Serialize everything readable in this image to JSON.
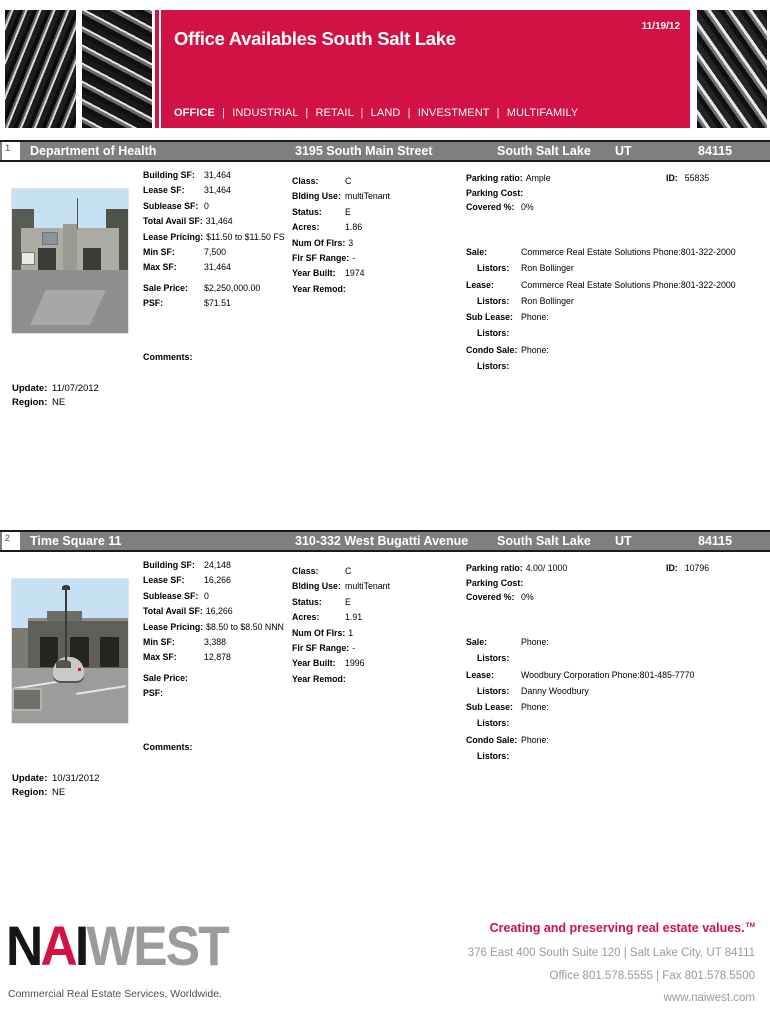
{
  "header": {
    "title": "Office Availables South Salt Lake",
    "date": "11/19/12",
    "nav": [
      "OFFICE",
      "INDUSTRIAL",
      "RETAIL",
      "LAND",
      "INVESTMENT",
      "MULTIFAMILY"
    ],
    "nav_separator": "|"
  },
  "colors": {
    "accent": "#D21145",
    "listing_bar": "#7F7F7F"
  },
  "listings": [
    {
      "num": "1",
      "name": "Department of Health",
      "address": "3195 South Main Street",
      "city": "South Salt Lake",
      "state": "UT",
      "zip": "84115",
      "col1": [
        {
          "label": "Building SF:",
          "value": "31,464"
        },
        {
          "label": "Lease SF:",
          "value": "31,464"
        },
        {
          "label": "Sublease SF:",
          "value": "0"
        },
        {
          "label": "Total Avail SF:",
          "value": "31,464"
        },
        {
          "label": "Lease Pricing:",
          "value": "$11.50 to $11.50 FS"
        },
        {
          "label": "Min SF:",
          "value": "7,500"
        },
        {
          "label": "Max SF:",
          "value": "31,464"
        }
      ],
      "col1b": [
        {
          "label": "Sale Price:",
          "value": "$2,250,000.00"
        },
        {
          "label": "PSF:",
          "value": "$71.51"
        }
      ],
      "col2": [
        {
          "label": "Class:",
          "value": "C"
        },
        {
          "label": "Blding Use:",
          "value": "multiTenant"
        },
        {
          "label": "Status:",
          "value": "E"
        },
        {
          "label": "Acres:",
          "value": "1.86"
        },
        {
          "label": "Num Of Flrs:",
          "value": "3"
        },
        {
          "label": "Flr SF Range:",
          "value": "-"
        },
        {
          "label": "Year Built:",
          "value": "1974"
        },
        {
          "label": "Year Remod:",
          "value": ""
        }
      ],
      "col3": [
        {
          "label": "Parking ratio:",
          "value": "Ample"
        },
        {
          "label": "Parking Cost:",
          "value": ""
        },
        {
          "label": "Covered %:",
          "value": "0%"
        }
      ],
      "id_label": "ID:",
      "id_value": "55835",
      "contacts": [
        {
          "label": "Sale:",
          "value": "Commerce Real Estate Solutions  Phone:801-322-2000"
        },
        {
          "label": "Listors:",
          "value": "Ron Bollinger"
        },
        {
          "label": "Lease:",
          "value": "Commerce Real Estate Solutions Phone:801-322-2000"
        },
        {
          "label": "Listors:",
          "value": "Ron Bollinger"
        },
        {
          "label": "Sub Lease:",
          "value": "Phone:"
        },
        {
          "label": "Listors:",
          "value": ""
        },
        {
          "label": "Condo Sale:",
          "value": "Phone:"
        },
        {
          "label": "Listors:",
          "value": ""
        }
      ],
      "comments_label": "Comments:",
      "update_label": "Update:",
      "update_value": "11/07/2012",
      "region_label": "Region:",
      "region_value": "NE"
    },
    {
      "num": "2",
      "name": "Time Square 11",
      "address": "310-332 West Bugatti Avenue",
      "city": "South Salt Lake",
      "state": "UT",
      "zip": "84115",
      "col1": [
        {
          "label": "Building SF:",
          "value": "24,148"
        },
        {
          "label": "Lease SF:",
          "value": "16,266"
        },
        {
          "label": "Sublease SF:",
          "value": "0"
        },
        {
          "label": "Total Avail SF:",
          "value": "16,266"
        },
        {
          "label": "Lease Pricing:",
          "value": "$8.50 to $8.50 NNN"
        },
        {
          "label": "Min SF:",
          "value": "3,388"
        },
        {
          "label": "Max SF:",
          "value": "12,878"
        }
      ],
      "col1b": [
        {
          "label": "Sale Price:",
          "value": ""
        },
        {
          "label": "PSF:",
          "value": ""
        }
      ],
      "col2": [
        {
          "label": "Class:",
          "value": "C"
        },
        {
          "label": "Blding Use:",
          "value": "multiTenant"
        },
        {
          "label": "Status:",
          "value": "E"
        },
        {
          "label": "Acres:",
          "value": "1.91"
        },
        {
          "label": "Num Of Flrs:",
          "value": "1"
        },
        {
          "label": "Flr SF Range:",
          "value": "-"
        },
        {
          "label": "Year Built:",
          "value": "1996"
        },
        {
          "label": "Year Remod:",
          "value": ""
        }
      ],
      "col3": [
        {
          "label": "Parking ratio:",
          "value": "4.00/ 1000"
        },
        {
          "label": "Parking Cost:",
          "value": ""
        },
        {
          "label": "Covered %:",
          "value": "0%"
        }
      ],
      "id_label": "ID:",
      "id_value": "10796",
      "contacts": [
        {
          "label": "Sale:",
          "value": "Phone:"
        },
        {
          "label": "Listors:",
          "value": ""
        },
        {
          "label": "Lease:",
          "value": "Woodbury Corporation Phone:801-485-7770"
        },
        {
          "label": "Listors:",
          "value": "Danny Woodbury"
        },
        {
          "label": "Sub Lease:",
          "value": "Phone:"
        },
        {
          "label": "Listors:",
          "value": ""
        },
        {
          "label": "Condo Sale:",
          "value": "Phone:"
        },
        {
          "label": "Listors:",
          "value": ""
        }
      ],
      "comments_label": "Comments:",
      "update_label": "Update:",
      "update_value": "10/31/2012",
      "region_label": "Region:",
      "region_value": "NE"
    }
  ],
  "footer": {
    "logo_n": "N",
    "logo_a": "A",
    "logo_i": "I",
    "logo_west": "WEST",
    "logo_sub": "Commercial Real Estate Services, Worldwide.",
    "tagline": "Creating and preserving real estate values.",
    "tagline_tm": "TM",
    "address": "376 East 400 South Suite 120 | Salt Lake City, UT 84111",
    "phone": "Office 801.578.5555 | Fax 801.578.5500",
    "website": "www.naiwest.com"
  }
}
